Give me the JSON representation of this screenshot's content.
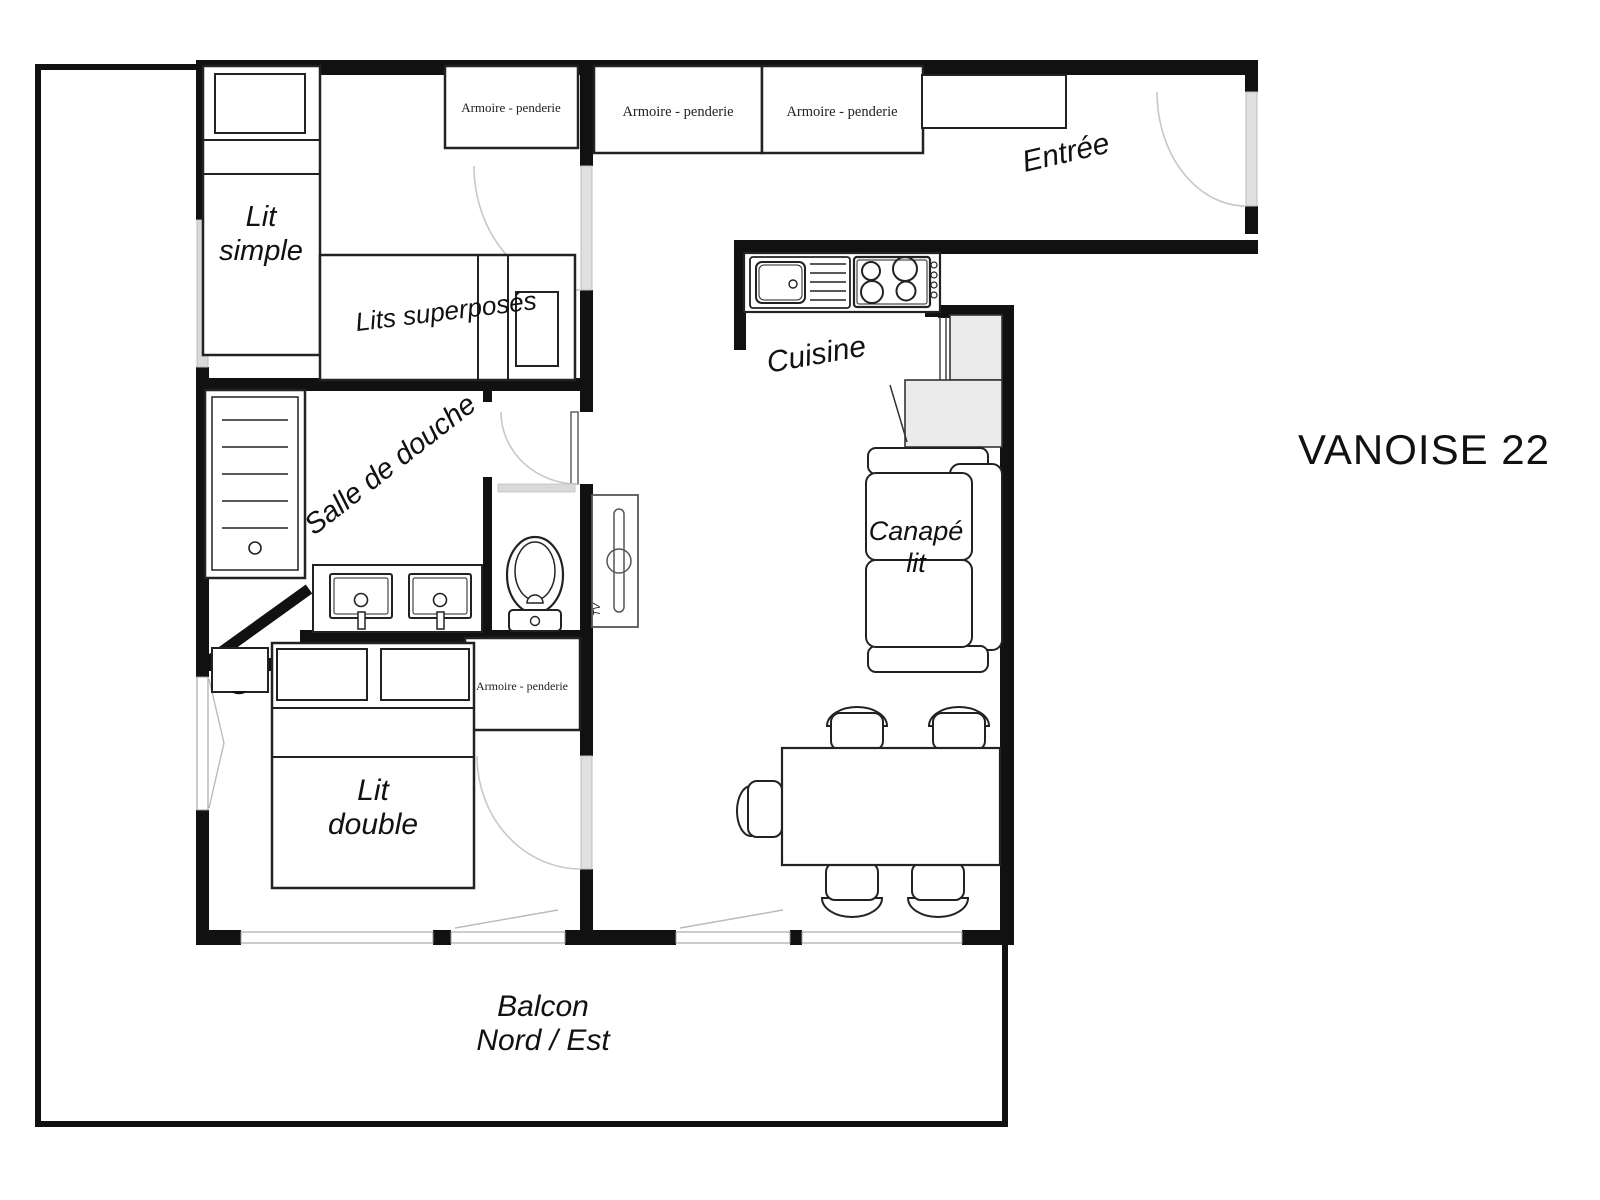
{
  "title": "VANOISE 22",
  "wardrobe_label": "Armoire - penderie",
  "rooms": {
    "entry": "Entrée",
    "kitchen": "Cuisine",
    "shower_room": "Salle de douche",
    "tv_unit": "TV",
    "balcony_line1": "Balcon",
    "balcony_line2": "Nord / Est",
    "single_bed_line1": "Lit",
    "single_bed_line2": "simple",
    "bunk_beds": "Lits superposés",
    "double_bed_line1": "Lit",
    "double_bed_line2": "double",
    "sofa_line1": "Canapé",
    "sofa_line2": "lit"
  },
  "colors": {
    "wall": "#111111",
    "door_leaf": "#e0e0e0",
    "door_swing": "#c8c8c8",
    "appliance_fill": "#ebebeb",
    "window_fill": "#d9d9d9",
    "text": "#111111"
  }
}
